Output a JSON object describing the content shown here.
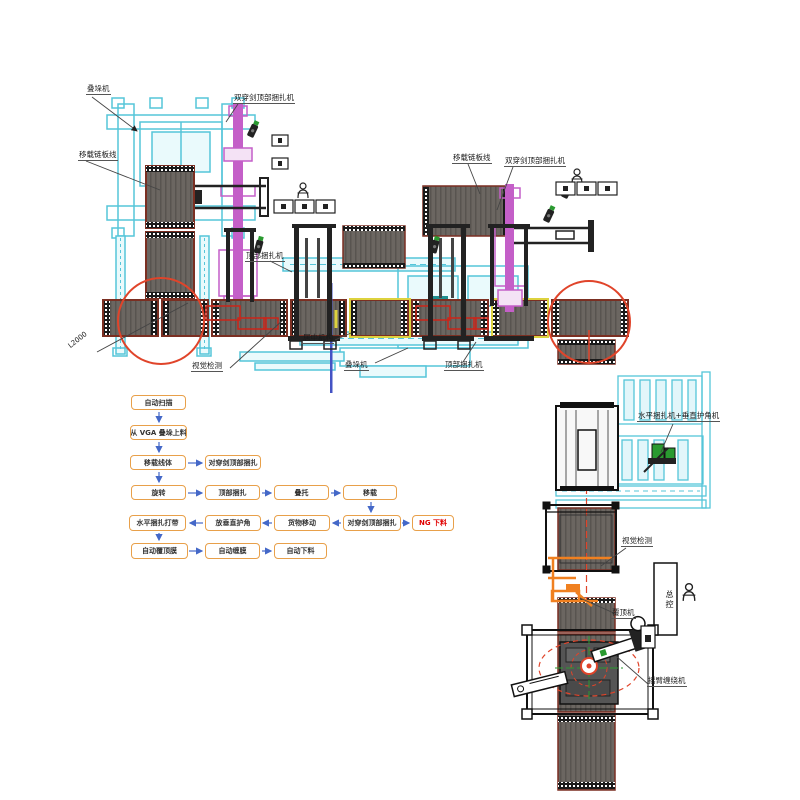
{
  "diagram_title": "码垛包装线布局图",
  "labels": {
    "stacker": "叠垛机",
    "transfer_chain_line": "移载链板线",
    "double_sword_top_strapping": "双穿剑顶部捆扎机",
    "top_strapping": "顶部捆扎机",
    "centering_mechanism": "居中机构",
    "vision_inspection": "视觉检测",
    "dimension": "L2000",
    "horizontal_strapping_corner": "水平捆扎机+垂直护角机",
    "master_control": "总控",
    "top_film_machine": "覆顶机",
    "arm_wrapping_machine": "摇臂缠绕机"
  },
  "flow": {
    "r1": [
      "自动扫描"
    ],
    "r2": [
      "从 VGA 叠垛上料"
    ],
    "r3": [
      "移载线体",
      "对穿剑顶部捆扎"
    ],
    "r4": [
      "旋转",
      "顶部捆扎",
      "叠托",
      "移载"
    ],
    "r5": [
      "水平捆扎打带",
      "放垂直护角",
      "货物移动",
      "对穿剑顶部捆扎",
      "NG 下料"
    ],
    "r6": [
      "自动覆顶膜",
      "自动缠膜",
      "自动下料"
    ]
  },
  "colors": {
    "conveyor_gray": "#6b6661",
    "conveyor_edge": "#7b2f22",
    "cyan_machine": "#55c5d9",
    "purple_machine": "#c45fc8",
    "highlight_red": "#e0442a",
    "frame_yellow": "#ddd23e",
    "centering_blue": "#4453c4",
    "flow_border_orange": "#e8a04a",
    "flow_arrow_blue": "#4468c8",
    "ng_red": "#e00000",
    "film_machine_orange": "#f08020",
    "camera_green": "#2a9a30"
  }
}
